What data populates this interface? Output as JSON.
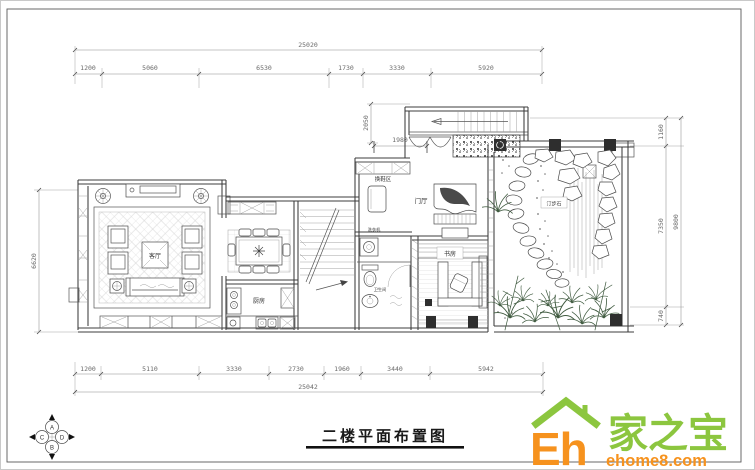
{
  "title": {
    "text": "二楼平面布置图"
  },
  "dims": {
    "top_total": "25020",
    "top_segments": [
      "1200",
      "5060",
      "6530",
      "1730",
      "3330",
      "5920"
    ],
    "bottom_segments": [
      "1200",
      "5110",
      "3330",
      "2730",
      "1960",
      "3440",
      "5942"
    ],
    "bottom_total": "25042",
    "left": "6620",
    "right_inner": [
      "1160",
      "7350",
      "740"
    ],
    "right_outer": "9800",
    "entry_depth": "2050",
    "entry_width": "1980"
  },
  "rooms": {
    "living": "客厅",
    "kitchen": "厨房",
    "foyer": "门厅",
    "shoe_area": "换鞋区",
    "study": "书房",
    "bathroom": "卫生间",
    "washer": "洗衣机",
    "stones": "汀步石"
  },
  "compass": {
    "n": "A",
    "s": "B",
    "w": "C",
    "e": "D"
  },
  "logo": {
    "eh": "Eh",
    "brand": "家之宝",
    "site": "ehome8.com",
    "green": "#8CC63F",
    "orange": "#F6921E"
  }
}
